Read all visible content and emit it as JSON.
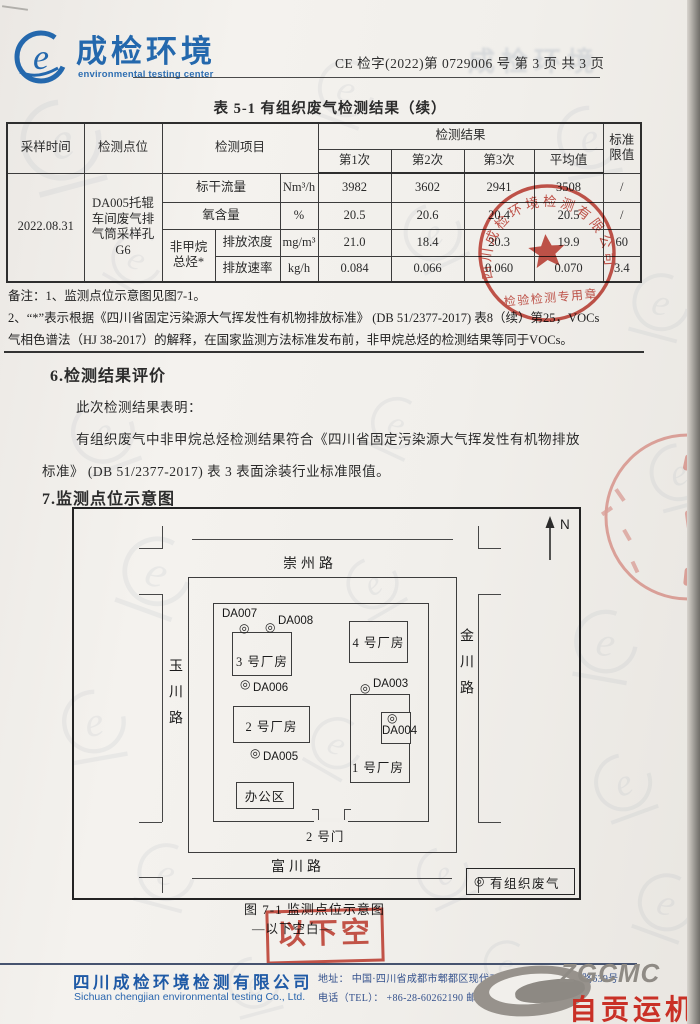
{
  "header": {
    "logo_cn": "成检环境",
    "logo_en": "environmental testing center",
    "doc_no": "CE 检字(2022)第 0729006 号  第 3 页 共 3 页"
  },
  "table": {
    "title": "表 5-1  有组织废气检测结果（续）",
    "headers": {
      "sample_time": "采样时间",
      "point": "检测点位",
      "item": "检测项目",
      "result": "检测结果",
      "n1": "第1次",
      "n2": "第2次",
      "n3": "第3次",
      "avg": "平均值",
      "limit": "标准限值"
    },
    "sample_time": "2022.08.31",
    "point": "DA005托辊车间废气排气筒采样孔G6",
    "rows": [
      {
        "group": "",
        "item": "标干流量",
        "unit": "Nm³/h",
        "v": [
          "3982",
          "3602",
          "2941",
          "3508",
          "/"
        ]
      },
      {
        "group": "",
        "item": "氧含量",
        "unit": "%",
        "v": [
          "20.5",
          "20.6",
          "20.4",
          "20.5",
          "/"
        ]
      },
      {
        "group": "非甲烷总烃*",
        "item": "排放浓度",
        "unit": "mg/m³",
        "v": [
          "21.0",
          "18.4",
          "20.3",
          "19.9",
          "60"
        ]
      },
      {
        "group": "",
        "item": "排放速率",
        "unit": "kg/h",
        "v": [
          "0.084",
          "0.066",
          "0.060",
          "0.070",
          "3.4"
        ]
      }
    ],
    "notes": [
      "备注：1、监测点位示意图见图7-1。",
      "2、“*”表示根据《四川省固定污染源大气挥发性有机物排放标准》 (DB 51/2377-2017) 表8（续）第25，VOCs",
      "气相色谱法（HJ 38-2017）的解释，在国家监测方法标准发布前，非甲烷总烃的检测结果等同于VOCs。"
    ]
  },
  "section6": {
    "heading": "6.检测结果评价",
    "p1": "此次检测结果表明：",
    "p2": "有组织废气中非甲烷总烃检测结果符合《四川省固定污染源大气挥发性有机物排放",
    "p3": "标准》 (DB 51/2377-2017) 表 3 表面涂装行业标准限值。"
  },
  "section7": {
    "heading": "7.监测点位示意图",
    "caption": "图 7-1 监测点位示意图",
    "blank": "—以下空白—"
  },
  "map": {
    "north": "N",
    "symbol": "◎",
    "roads": {
      "top": "崇州路",
      "bottom": "富川路",
      "left": "玉川路",
      "right": "金川路"
    },
    "buildings": {
      "b1": "1 号厂房",
      "b2": "2 号厂房",
      "b3": "3 号厂房",
      "b4": "4 号厂房",
      "office": "办公区"
    },
    "gate": "2 号门",
    "points": {
      "da3": "DA003",
      "da4": "DA004",
      "da5": "DA005",
      "da6": "DA006",
      "da7": "DA007",
      "da8": "DA008"
    },
    "legend_symbol": "◎",
    "legend_text": "有组织废气"
  },
  "stamps": {
    "round_company": "四川成检环境检测有限公司",
    "round_sub": "检验检测专用章",
    "blank_text": "以下空白"
  },
  "footer": {
    "company_cn": "四川成检环境检测有限公司",
    "company_en": "Sichuan chengjian environmental testing Co., Ltd.",
    "address": "地址： 中国·四川省成都市郫都区现代工业港北片区港东二路639号",
    "phone": "电话（TEL）： +86-28-60262190  邮编：611730",
    "brand_en": "ZGCMC",
    "brand_cn": "自贡运机"
  },
  "colors": {
    "brand_blue": "#2468ad",
    "stamp_red": "#c0392f",
    "brand_red": "#c93026"
  }
}
